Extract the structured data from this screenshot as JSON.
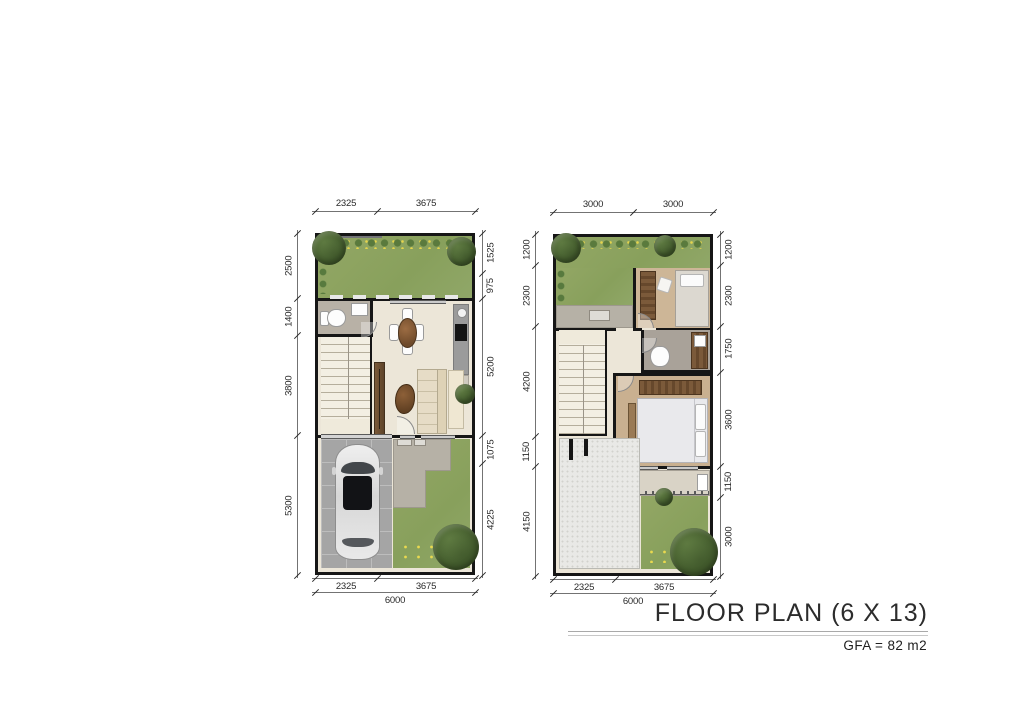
{
  "title": {
    "main": "FLOOR PLAN (6 X 13)",
    "sub": "GFA = 82 m2"
  },
  "plans": {
    "ground": {
      "dims": {
        "top": [
          "2325",
          "3675"
        ],
        "left": [
          "2500",
          "1400",
          "3800",
          "5300"
        ],
        "right": [
          "1525",
          "975",
          "5200",
          "1075",
          "4225"
        ],
        "bottom": [
          "2325",
          "3675"
        ],
        "bottom_total": [
          "6000"
        ]
      }
    },
    "upper": {
      "dims": {
        "top": [
          "3000",
          "3000"
        ],
        "left": [
          "1200",
          "2300",
          "4200",
          "1150",
          "4150"
        ],
        "right": [
          "1200",
          "2300",
          "1750",
          "3600",
          "1150",
          "3000"
        ],
        "bottom": [
          "2325",
          "3675"
        ],
        "bottom_total": [
          "6000"
        ]
      }
    }
  },
  "colors": {
    "grass": "#93a765",
    "floor": "#ece6d8",
    "wood_floor": "#cdb697",
    "furniture_wood": "#7b5a3a",
    "paving": "#b6b1a6",
    "carport": "#a5a5a5",
    "wall": "#161616",
    "dim_text": "#2a2a2a"
  }
}
